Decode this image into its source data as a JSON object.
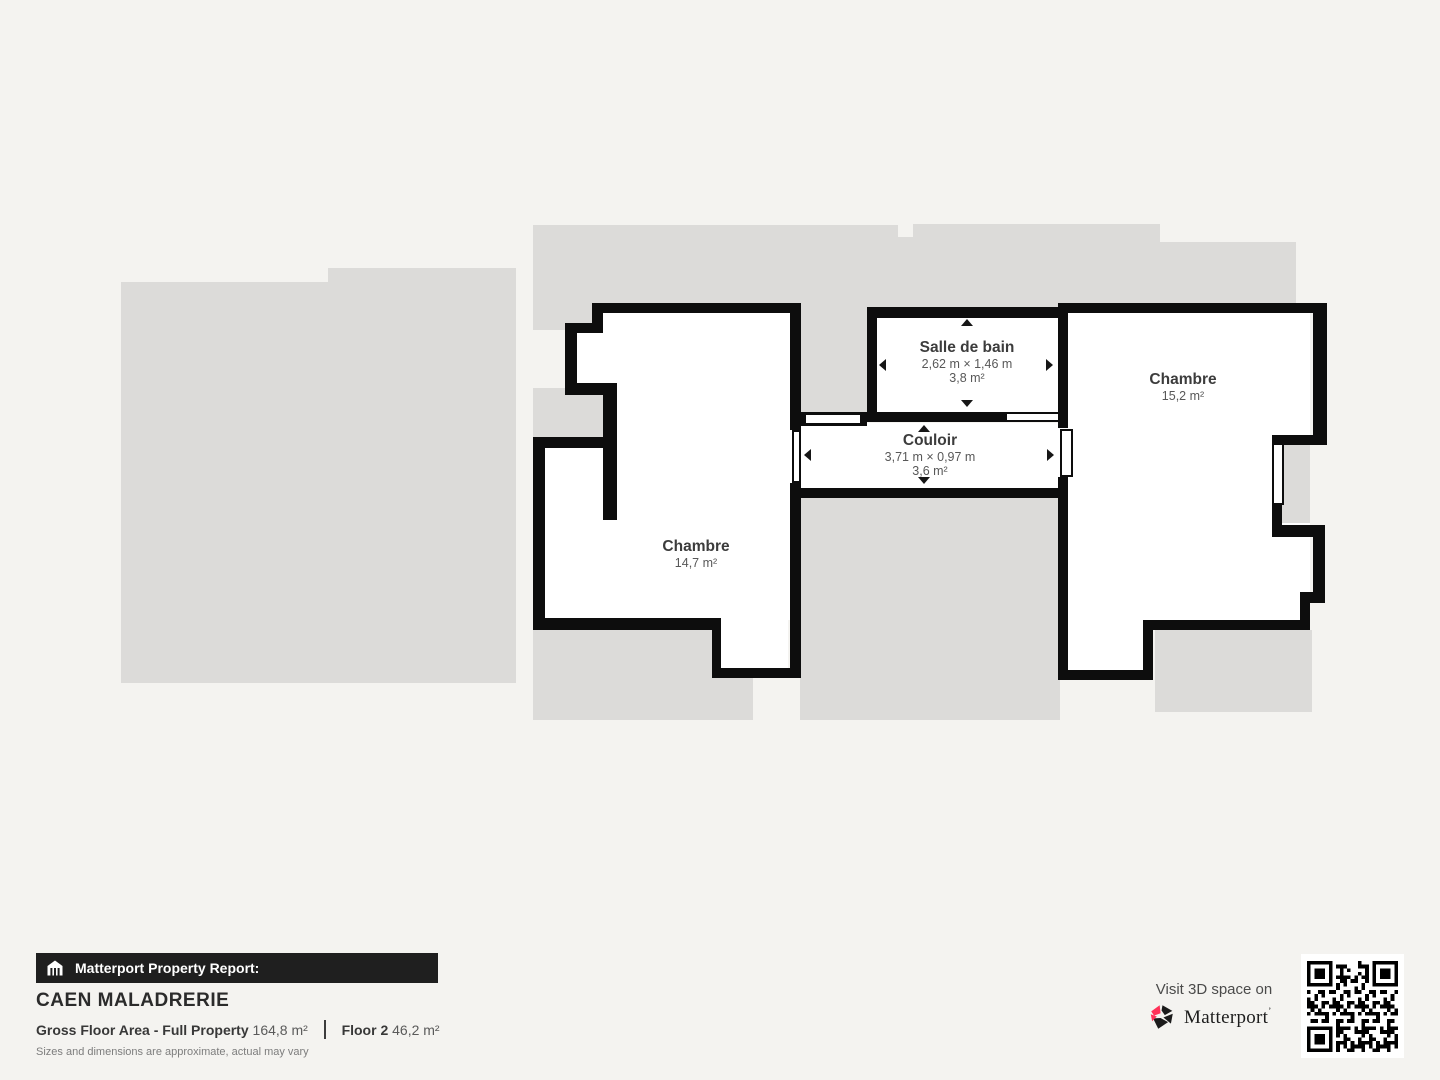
{
  "floor_plan": {
    "rooms": [
      {
        "name": "Salle de bain",
        "dimensions": "2,62 m × 1,46 m",
        "area": "3,8 m²"
      },
      {
        "name": "Couloir",
        "dimensions": "3,71 m × 0,97 m",
        "area": "3,6 m²"
      },
      {
        "name": "Chambre",
        "area": "15,2 m²"
      },
      {
        "name": "Chambre",
        "area": "14,7 m²"
      }
    ],
    "colors": {
      "wall": "#0d0d0d",
      "room_fill": "#ffffff",
      "silhouette": "#dcdbd9",
      "background": "#f4f3f0"
    }
  },
  "footer": {
    "report_label": "Matterport Property Report:",
    "property_name": "CAEN MALADRERIE",
    "area_label": "Gross Floor Area - Full Property",
    "area_value": "164,8 m²",
    "floor_label": "Floor 2",
    "floor_value": "46,2 m²",
    "disclaimer": "Sizes and dimensions are approximate, actual may vary"
  },
  "cta": {
    "visit_text": "Visit 3D space on",
    "brand": "Matterport",
    "brand_accent": "#ff3158"
  }
}
